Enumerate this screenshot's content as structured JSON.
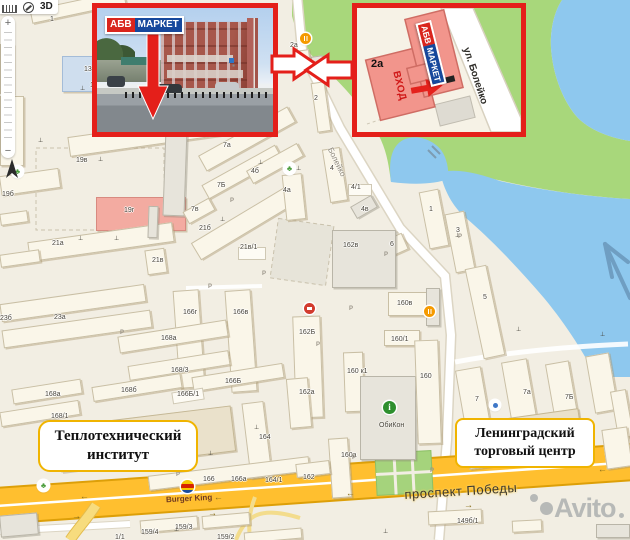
{
  "map": {
    "controls": {
      "mode_3d": "3D",
      "zoom_in": "+",
      "zoom_out": "−"
    },
    "street_labels": {
      "boleyko": "Болейко",
      "prospekt": "проспект Победы"
    },
    "landmark_boxes": [
      {
        "line1": "Теплотехнический",
        "line2": "институт"
      },
      {
        "line1": "Ленинградский",
        "line2": "торговый центр"
      }
    ],
    "poi_texts": {
      "burger_king": "Burger King",
      "obikon": "ОбиКон"
    },
    "building_labels": [
      [
        "1",
        50,
        16
      ],
      [
        "13",
        84,
        66
      ],
      [
        "11",
        90,
        82
      ],
      [
        "17Б",
        2,
        118
      ],
      [
        "19в",
        76,
        157
      ],
      [
        "19б",
        2,
        191
      ],
      [
        "19г",
        124,
        207
      ],
      [
        "21а",
        52,
        240
      ],
      [
        "21в",
        152,
        257
      ],
      [
        "21б",
        199,
        225
      ],
      [
        "21в/1",
        240,
        244
      ],
      [
        "23б",
        0,
        315
      ],
      [
        "23а",
        54,
        314
      ],
      [
        "7а",
        223,
        142
      ],
      [
        "7Б",
        217,
        182
      ],
      [
        "7в",
        191,
        206
      ],
      [
        "4б",
        251,
        168
      ],
      [
        "4а",
        283,
        187
      ],
      [
        "2а",
        290,
        42
      ],
      [
        "2",
        314,
        95
      ],
      [
        "4",
        330,
        165
      ],
      [
        "4/1",
        351,
        184
      ],
      [
        "4в",
        361,
        206
      ],
      [
        "1",
        429,
        206
      ],
      [
        "3",
        456,
        227
      ],
      [
        "6",
        390,
        241
      ],
      [
        "5",
        483,
        294
      ],
      [
        "162в",
        343,
        242
      ],
      [
        "162Б",
        299,
        329
      ],
      [
        "162а",
        299,
        389
      ],
      [
        "160в",
        397,
        300
      ],
      [
        "160/1",
        391,
        336
      ],
      [
        "160 к1",
        347,
        368
      ],
      [
        "160",
        420,
        373
      ],
      [
        "160а",
        341,
        452
      ],
      [
        "166г",
        183,
        309
      ],
      [
        "166в",
        233,
        309
      ],
      [
        "168а",
        161,
        335
      ],
      [
        "168/3",
        171,
        367
      ],
      [
        "166Б",
        225,
        378
      ],
      [
        "168б",
        121,
        387
      ],
      [
        "166Б/1",
        177,
        391
      ],
      [
        "168а",
        45,
        391
      ],
      [
        "168/1",
        51,
        413
      ],
      [
        "168б/2",
        137,
        425
      ],
      [
        "164",
        259,
        434
      ],
      [
        "166",
        203,
        476
      ],
      [
        "166а",
        231,
        476
      ],
      [
        "164/1",
        265,
        477
      ],
      [
        "162",
        303,
        474
      ],
      [
        "7",
        475,
        396
      ],
      [
        "7а",
        523,
        389
      ],
      [
        "7Б",
        565,
        394
      ],
      [
        "158",
        503,
        443
      ],
      [
        "159/3",
        175,
        524
      ],
      [
        "159/4",
        141,
        529
      ],
      [
        "1/1",
        115,
        534
      ],
      [
        "159/2",
        217,
        534
      ],
      [
        "149б/1",
        457,
        518
      ]
    ],
    "buildings": [
      [
        30,
        0,
        96,
        14,
        -12,
        "c"
      ],
      [
        62,
        56,
        64,
        36,
        0,
        "b"
      ],
      [
        0,
        44,
        14,
        50,
        0,
        "c"
      ],
      [
        0,
        96,
        24,
        70,
        0,
        "c"
      ],
      [
        68,
        126,
        158,
        20,
        -8,
        "c"
      ],
      [
        0,
        172,
        60,
        20,
        -8,
        "c"
      ],
      [
        96,
        197,
        90,
        34,
        0,
        "r"
      ],
      [
        28,
        232,
        146,
        20,
        -8,
        "c"
      ],
      [
        146,
        249,
        20,
        25,
        -8,
        "c"
      ],
      [
        0,
        294,
        146,
        18,
        -8,
        "c"
      ],
      [
        2,
        320,
        150,
        18,
        -8,
        "c"
      ],
      [
        164,
        128,
        22,
        88,
        2,
        "g"
      ],
      [
        148,
        206,
        10,
        32,
        2,
        "g"
      ],
      [
        188,
        213,
        112,
        20,
        -31,
        "c"
      ],
      [
        238,
        247,
        28,
        13,
        0,
        "w"
      ],
      [
        196,
        130,
        102,
        18,
        -29,
        "c"
      ],
      [
        200,
        164,
        84,
        16,
        -29,
        "c"
      ],
      [
        184,
        204,
        30,
        14,
        -29,
        "c"
      ],
      [
        246,
        156,
        58,
        15,
        -29,
        "c"
      ],
      [
        284,
        174,
        20,
        46,
        -6,
        "c"
      ],
      [
        314,
        82,
        14,
        50,
        -8,
        "c"
      ],
      [
        312,
        56,
        12,
        20,
        -8,
        "g"
      ],
      [
        296,
        50,
        14,
        16,
        -8,
        "c"
      ],
      [
        326,
        148,
        18,
        54,
        -9,
        "c"
      ],
      [
        348,
        184,
        24,
        12,
        0,
        "w"
      ],
      [
        352,
        200,
        24,
        14,
        -30,
        "g"
      ],
      [
        424,
        190,
        20,
        58,
        -11,
        "c"
      ],
      [
        450,
        212,
        20,
        60,
        -11,
        "c"
      ],
      [
        474,
        266,
        22,
        92,
        -12,
        "c"
      ],
      [
        386,
        236,
        20,
        18,
        -24,
        "c"
      ],
      [
        176,
        290,
        26,
        98,
        -4,
        "c"
      ],
      [
        228,
        290,
        26,
        102,
        -4,
        "c"
      ],
      [
        332,
        230,
        64,
        58,
        0,
        "g"
      ],
      [
        294,
        316,
        28,
        102,
        -2,
        "c"
      ],
      [
        288,
        378,
        22,
        50,
        -5,
        "c"
      ],
      [
        388,
        292,
        40,
        24,
        0,
        "c"
      ],
      [
        426,
        288,
        14,
        38,
        0,
        "g"
      ],
      [
        384,
        330,
        36,
        16,
        0,
        "c"
      ],
      [
        344,
        352,
        20,
        60,
        -2,
        "c"
      ],
      [
        360,
        376,
        56,
        84,
        0,
        "g"
      ],
      [
        416,
        340,
        24,
        104,
        -2,
        "c"
      ],
      [
        330,
        438,
        20,
        60,
        -4,
        "c"
      ],
      [
        118,
        328,
        110,
        17,
        -9,
        "c"
      ],
      [
        128,
        358,
        102,
        15,
        -9,
        "c"
      ],
      [
        92,
        380,
        90,
        15,
        -9,
        "c"
      ],
      [
        192,
        370,
        92,
        15,
        -9,
        "c"
      ],
      [
        172,
        390,
        32,
        12,
        -9,
        "w"
      ],
      [
        12,
        384,
        70,
        15,
        -9,
        "c"
      ],
      [
        0,
        406,
        80,
        15,
        -9,
        "c"
      ],
      [
        58,
        416,
        176,
        46,
        -7,
        "t"
      ],
      [
        246,
        402,
        22,
        76,
        -7,
        "c"
      ],
      [
        148,
        466,
        162,
        15,
        -7,
        "c"
      ],
      [
        296,
        462,
        34,
        14,
        -7,
        "c"
      ],
      [
        460,
        368,
        26,
        60,
        -10,
        "c"
      ],
      [
        506,
        360,
        26,
        60,
        -10,
        "c"
      ],
      [
        550,
        362,
        24,
        60,
        -10,
        "c"
      ],
      [
        590,
        354,
        24,
        58,
        -10,
        "c"
      ],
      [
        614,
        390,
        16,
        48,
        -10,
        "c"
      ],
      [
        466,
        416,
        116,
        46,
        -8,
        "t"
      ],
      [
        604,
        428,
        26,
        40,
        -8,
        "c"
      ],
      [
        140,
        518,
        58,
        13,
        -5,
        "c"
      ],
      [
        202,
        514,
        48,
        13,
        -5,
        "c"
      ],
      [
        244,
        530,
        58,
        11,
        -5,
        "c"
      ],
      [
        428,
        510,
        54,
        14,
        -3,
        "c"
      ],
      [
        512,
        520,
        30,
        12,
        -3,
        "c"
      ],
      [
        596,
        524,
        34,
        14,
        0,
        "g"
      ],
      [
        0,
        514,
        38,
        22,
        -5,
        "g"
      ],
      [
        0,
        212,
        28,
        12,
        -8,
        "c"
      ],
      [
        0,
        252,
        40,
        13,
        -8,
        "c"
      ]
    ],
    "monuments": [
      [
        80,
        86
      ],
      [
        38,
        138
      ],
      [
        98,
        157
      ],
      [
        258,
        160
      ],
      [
        296,
        166
      ],
      [
        220,
        217
      ],
      [
        78,
        236
      ],
      [
        114,
        236
      ],
      [
        208,
        451
      ],
      [
        254,
        425
      ],
      [
        489,
        422
      ],
      [
        600,
        332
      ],
      [
        516,
        327
      ],
      [
        383,
        529
      ],
      [
        174,
        527
      ],
      [
        455,
        233
      ]
    ],
    "parkings": [
      [
        230,
        198
      ],
      [
        208,
        284
      ],
      [
        262,
        271
      ],
      [
        316,
        342
      ],
      [
        349,
        306
      ],
      [
        384,
        252
      ],
      [
        458,
        234
      ],
      [
        352,
        455
      ],
      [
        176,
        472
      ],
      [
        120,
        330
      ],
      [
        430,
        468
      ]
    ],
    "trees": [
      [
        12,
        166
      ],
      [
        284,
        163
      ],
      [
        38,
        480
      ]
    ],
    "restaurants": [
      [
        300,
        33
      ],
      [
        424,
        306
      ]
    ],
    "shop_poi": [
      304,
      303
    ],
    "blue_poi": [
      490,
      400
    ],
    "info_poi": [
      389,
      407
    ],
    "lane_arrows": [
      [
        80,
        492,
        "l"
      ],
      [
        214,
        493,
        "l"
      ],
      [
        346,
        489,
        "l"
      ],
      [
        598,
        465,
        "l"
      ],
      [
        72,
        512,
        "r"
      ],
      [
        208,
        509,
        "r"
      ],
      [
        464,
        501,
        "r"
      ]
    ]
  },
  "inset_photo": {
    "logo_part1": "АБВ",
    "logo_part2": "МАРКЕТ"
  },
  "inset_map": {
    "logo_part1": "АБВ",
    "logo_part2": "МАРКЕТ",
    "building_label": "2а",
    "entrance_label": "ВХОД",
    "street_label": "ул. Болейко"
  },
  "watermark": {
    "text": "Avito"
  },
  "colors": {
    "accent_red": "#e41f1a",
    "logo_red": "#d9251d",
    "logo_blue": "#16489c",
    "water": "#8ec8ee",
    "green": "#a8d77b",
    "road_orange": "#ffbf2f",
    "landmark_border": "#f0b400"
  }
}
